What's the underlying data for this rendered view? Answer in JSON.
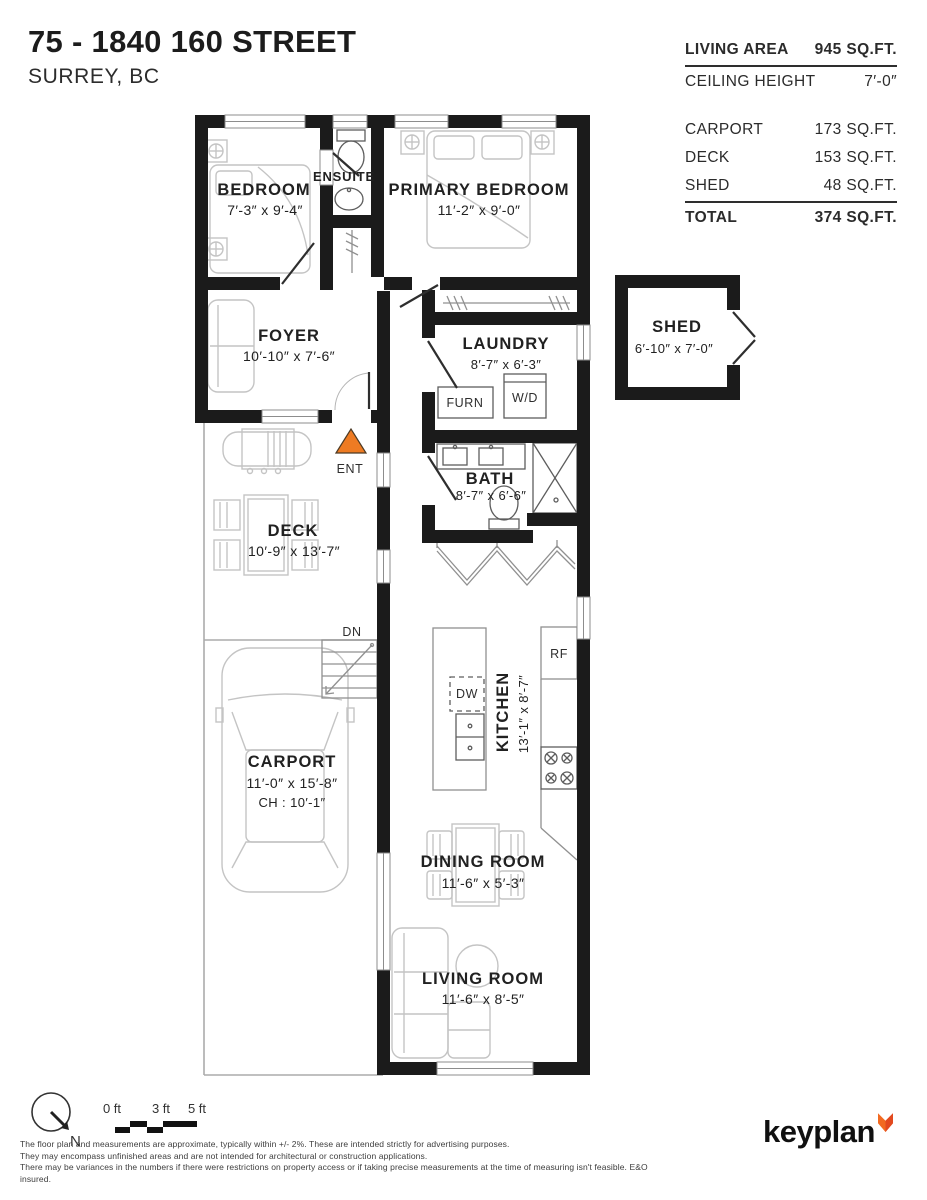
{
  "header": {
    "title": "75 - 1840 160 STREET",
    "subtitle": "SURREY, BC"
  },
  "stats": {
    "rows": [
      {
        "label": "LIVING AREA",
        "value": "945 SQ.FT."
      },
      {
        "label": "CEILING HEIGHT",
        "value": "7′-0″"
      },
      {
        "label": "CARPORT",
        "value": "173 SQ.FT."
      },
      {
        "label": "DECK",
        "value": "153 SQ.FT."
      },
      {
        "label": "SHED",
        "value": "48 SQ.FT."
      },
      {
        "label": "TOTAL",
        "value": "374 SQ.FT."
      }
    ]
  },
  "rooms": {
    "bedroom": {
      "name": "BEDROOM",
      "dims": "7′-3″ x 9′-4″"
    },
    "ensuite": {
      "name": "ENSUITE"
    },
    "primary": {
      "name": "PRIMARY BEDROOM",
      "dims": "11′-2″ x 9′-0″"
    },
    "foyer": {
      "name": "FOYER",
      "dims": "10′-10″ x 7′-6″"
    },
    "laundry": {
      "name": "LAUNDRY",
      "dims": "8′-7″ x 6′-3″"
    },
    "shed": {
      "name": "SHED",
      "dims": "6′-10″ x 7′-0″"
    },
    "bath": {
      "name": "BATH",
      "dims": "8′-7″ x 6′-6″"
    },
    "deck": {
      "name": "DECK",
      "dims": "10′-9″ x 13′-7″"
    },
    "carport": {
      "name": "CARPORT",
      "dims": "11′-0″ x 15′-8″",
      "ceiling": "CH : 10′-1″"
    },
    "kitchen": {
      "name": "KITCHEN",
      "dims": "13′-1″ x 8′-7″"
    },
    "dining": {
      "name": "DINING ROOM",
      "dims": "11′-6″ x 5′-3″"
    },
    "living": {
      "name": "LIVING ROOM",
      "dims": "11′-6″ x 8′-5″"
    }
  },
  "labels": {
    "ent": "ENT",
    "dn": "DN",
    "furn": "FURN",
    "wd": "W/D",
    "dw": "DW",
    "rf": "RF"
  },
  "scale": {
    "zero": "0 ft",
    "three": "3 ft",
    "five": "5 ft",
    "north": "N"
  },
  "disclaimer": {
    "line1": "The floor plan and measurements are approximate, typically within +/- 2%. These are intended strictly for advertising purposes.",
    "line2": "They may encompass unfinished areas and are not intended for architectural or construction applications.",
    "line3": "There may be variances in the numbers if there were restrictions on property access or if taking precise measurements at the time of measuring isn't feasible. E&O insured."
  },
  "brand": {
    "name": "keyplan"
  },
  "colors": {
    "accent_orange": "#EE7B23",
    "wall_black": "#1B1B1B",
    "furniture_gray": "#C4C4C4"
  }
}
